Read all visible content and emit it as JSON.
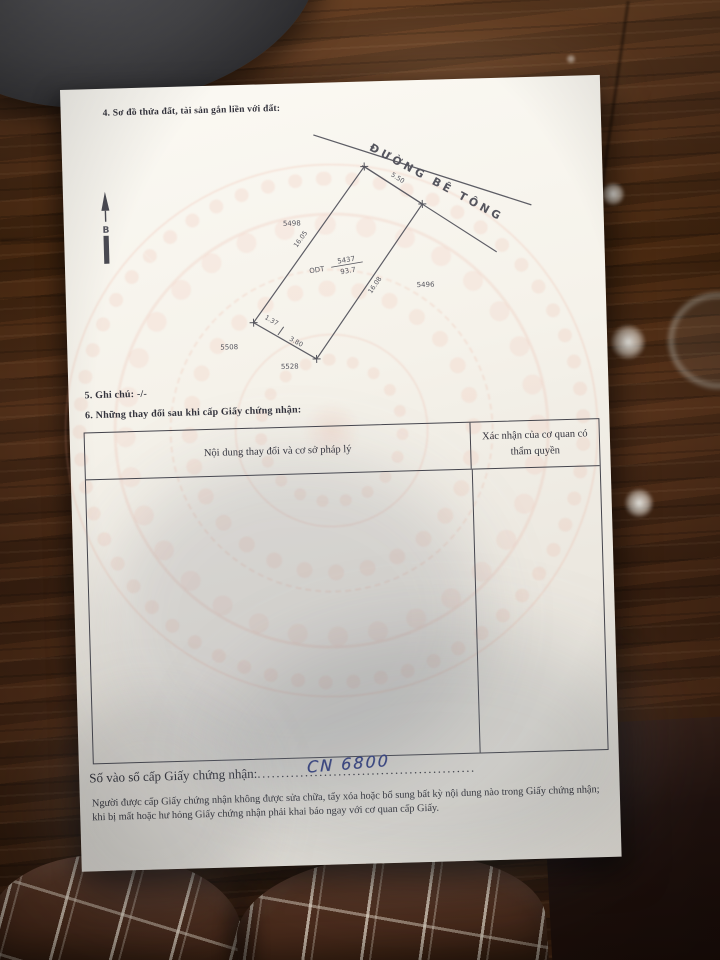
{
  "colors": {
    "paper": "#f2efe8",
    "printed_ink": "#2e2e36",
    "handwritten_ink": "#2c3a86",
    "wood": "#49290f",
    "watermark_pink": "#e89a86"
  },
  "document": {
    "section4_title": "4. Sơ đồ thửa đất, tài sản gắn liền với đất:",
    "north_arrow_label": "B",
    "diagram": {
      "road_label": "ĐƯỜNG BÊ TÔNG",
      "parcel": {
        "land_use_code": "ODT",
        "plot_number": "5437",
        "area": "93.7"
      },
      "measurements": {
        "front": "5.50",
        "left": "16.05",
        "right": "16.08",
        "bottom_short": "1.37",
        "bottom_long": "3.80"
      },
      "adjacent_plots": {
        "upper_left": "5498",
        "right": "5496",
        "lower_left": "5508",
        "bottom": "5528"
      }
    },
    "section5_title": "5. Ghi chú: -/-",
    "section6_title": "6. Những thay đổi sau khi cấp Giấy chứng nhận:",
    "changes_table": {
      "col_content_header": "Nội dung thay đổi và cơ sở pháp lý",
      "col_confirm_header": "Xác nhận của cơ quan có thẩm quyền"
    },
    "serial": {
      "label": "Số vào sổ cấp Giấy chứng nhận:",
      "dots": "..............................................",
      "handwritten_value": "CN 6800"
    },
    "footer_note": "Người được cấp Giấy chứng nhận không được sửa chữa, tẩy xóa hoặc bổ sung bất kỳ nội dung nào trong Giấy chứng nhận; khi bị mất hoặc hư hỏng Giấy chứng nhận phải khai báo ngay với cơ quan cấp Giấy."
  }
}
